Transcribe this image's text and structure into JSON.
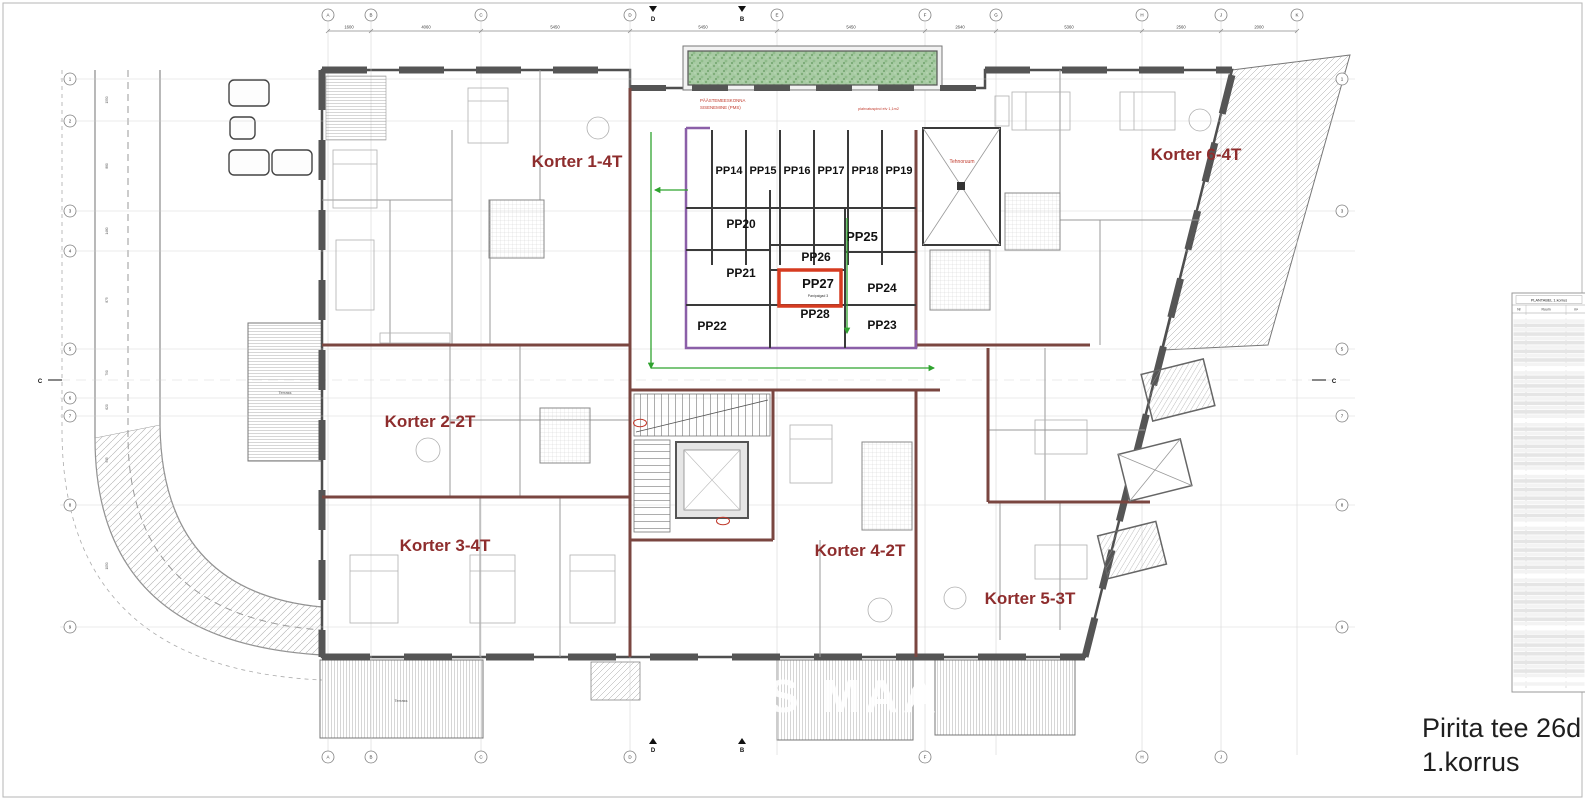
{
  "sheet": {
    "title_line1": "Pirita tee 26d",
    "title_line2": "1.korrus",
    "watermark": "S MAA"
  },
  "apartments": [
    {
      "label": "Korter 1-4T"
    },
    {
      "label": "Korter 2-2T"
    },
    {
      "label": "Korter 3-4T"
    },
    {
      "label": "Korter 4-2T"
    },
    {
      "label": "Korter 5-3T"
    },
    {
      "label": "Korter 6-4T"
    }
  ],
  "storage": {
    "units": [
      "PP14",
      "PP15",
      "PP16",
      "PP17",
      "PP18",
      "PP19",
      "PP20",
      "PP21",
      "PP22",
      "PP23",
      "PP24",
      "PP25",
      "PP26",
      "PP27",
      "PP28"
    ],
    "highlighted_unit": "PP27",
    "note": "Panipaigad 3"
  },
  "annotations": {
    "rescue_line1": "PÄÄSTEMEESKONNA",
    "rescue_line2": "SISENEMINE (PMS)",
    "blast_note": "plahvatuspind elv 1,1m2",
    "tech_room": "Tehnoruum",
    "terrace": "Terrass"
  },
  "grid": {
    "top_labels": [
      "A",
      "B",
      "C",
      "D",
      "E",
      "F",
      "G",
      "H",
      "J",
      "K"
    ],
    "side_labels": [
      "1",
      "2",
      "3",
      "4",
      "5",
      "6",
      "7",
      "8",
      "9"
    ],
    "top_dims": [
      "1600",
      "4060",
      "5450",
      "5450",
      "5450",
      "2640",
      "5360",
      "2560",
      "2000"
    ],
    "side_dims": [
      "1550",
      "880",
      "1480",
      "875",
      "790",
      "620",
      "935",
      "1050"
    ],
    "section_markers": [
      "D",
      "B",
      "C"
    ]
  },
  "table": {
    "title": "PLANTABEL 1.korrus",
    "columns": [
      "Nr",
      "Ruum",
      "m²"
    ],
    "row_count": 86
  },
  "colors": {
    "exterior_wall": "#4f4f4f",
    "partition_wall": "#7a4640",
    "storage_outline": "#8b5fa8",
    "highlight_red": "#d63b20",
    "korter_label": "#8e2d2d",
    "red_note": "#c0392b",
    "evac_green": "#2fa32f",
    "planter_green": "#8fbc8a"
  }
}
